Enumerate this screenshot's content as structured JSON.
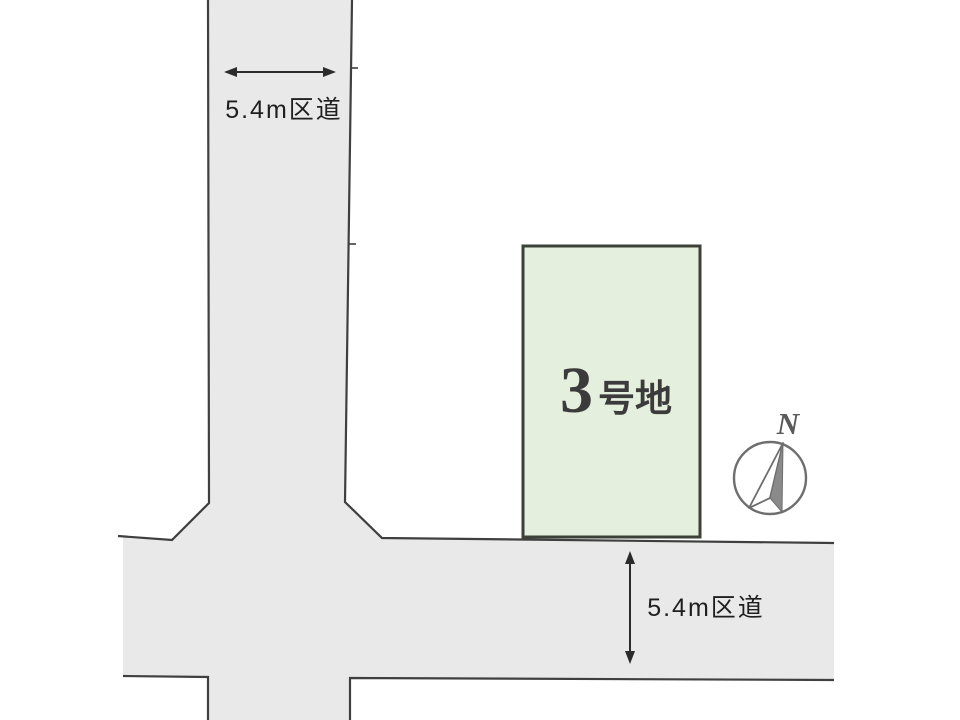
{
  "colors": {
    "background": "#ffffff",
    "road_fill": "#e9e9ea",
    "road_border": "#3f3f3f",
    "plot_fill": "#e4efdd",
    "plot_border": "#3b4136",
    "label_text": "#1f1f1f",
    "plot_text": "#3b3b3b",
    "compass_line": "#6e6e6e",
    "compass_dark": "#8a8a8a",
    "north_text": "#5a5a5a"
  },
  "vertical_road": {
    "label": "5.4m区道"
  },
  "horizontal_road": {
    "label": "5.4m区道"
  },
  "plot": {
    "number": "3",
    "suffix": "号地"
  },
  "compass": {
    "north_label": "N"
  },
  "icons": {
    "top_arrow": "horizontal-dimension-arrow",
    "bottom_arrow": "vertical-dimension-arrow",
    "compass": "north-compass-icon"
  }
}
